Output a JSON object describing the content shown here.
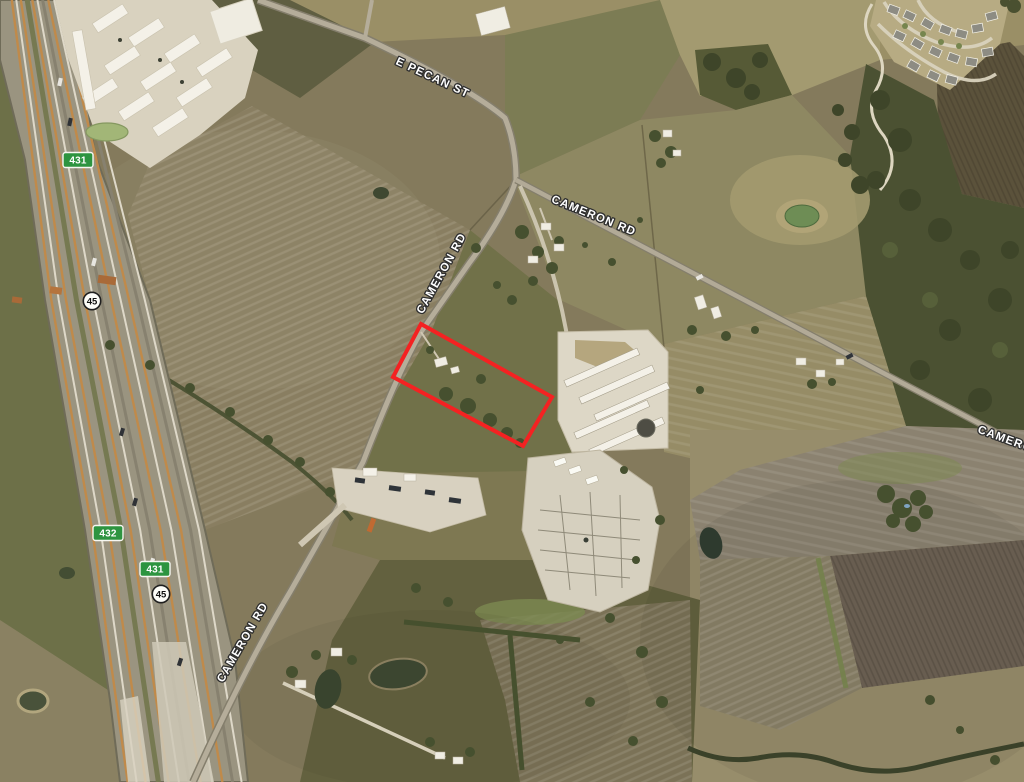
{
  "map": {
    "road_labels": [
      {
        "id": "e-pecan-st",
        "text": "E PECAN ST"
      },
      {
        "id": "cameron-rd-upper",
        "text": "CAMERON RD"
      },
      {
        "id": "cameron-rd-east",
        "text": "CAMERON RD"
      },
      {
        "id": "cameron-rd-lower",
        "text": "CAMERON RD"
      },
      {
        "id": "cameron-rd-right-edge",
        "text": "CAMERON"
      }
    ],
    "shields": {
      "green_431_top": "431",
      "circle_45_top": "45",
      "green_432": "432",
      "green_431_bottom": "431",
      "circle_45_bottom": "45"
    },
    "parcel": {
      "outline_color": "#f42222",
      "points": "421,324 552,397 523,446 393,377"
    },
    "colors": {
      "shield_green": "#2d9440",
      "shield_border": "#f7f7f2",
      "label_text": "#ffffff",
      "label_halo": "#2e2e2e"
    }
  }
}
